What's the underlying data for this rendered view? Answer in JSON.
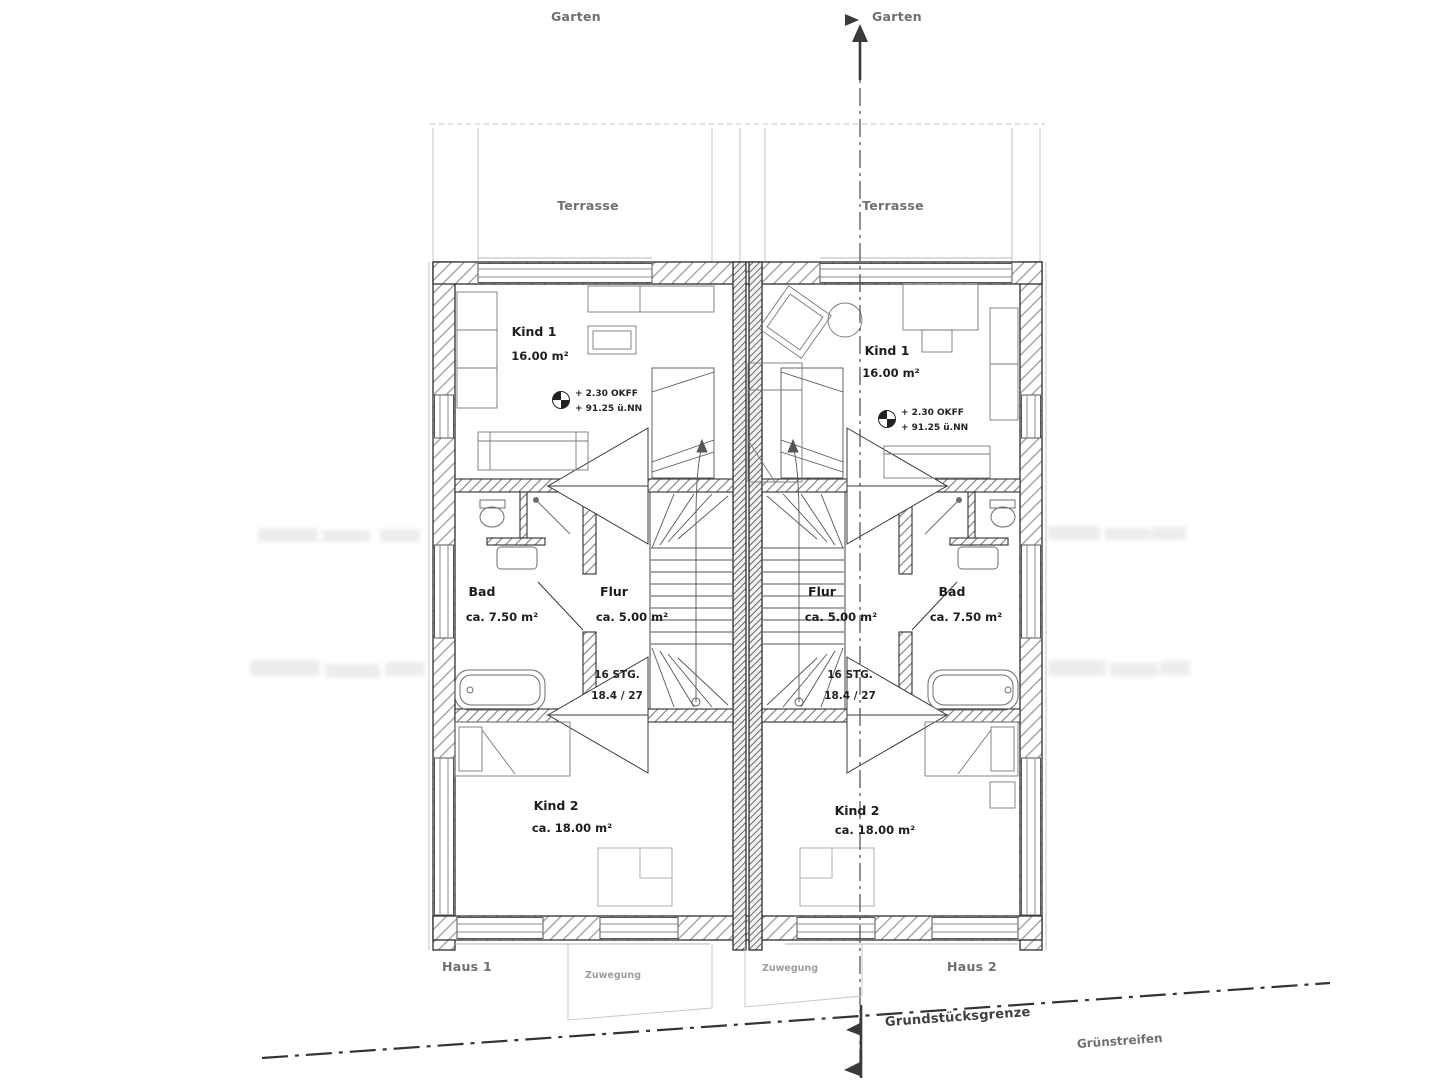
{
  "colors": {
    "ink": "#3a3a3a",
    "faint": "#c4c4c4",
    "label": "#1d1d1d"
  },
  "site": {
    "garten_left": "Garten",
    "garten_right": "Garten",
    "terrasse_left": "Terrasse",
    "terrasse_right": "Terrasse",
    "grundstuecksgrenze": "Grundstücksgrenze",
    "gruenstreifen": "Grünstreifen",
    "zuwegung_left": "Zuwegung",
    "zuwegung_right": "Zuwegung"
  },
  "haus1": {
    "name": "Haus 1",
    "kind1": {
      "name": "Kind 1",
      "area": "16.00 m²"
    },
    "kind2": {
      "name": "Kind 2",
      "area": "ca. 18.00 m²"
    },
    "bad": {
      "name": "Bad",
      "area": "ca. 7.50 m²"
    },
    "flur": {
      "name": "Flur",
      "area": "ca. 5.00 m²"
    },
    "stairs": {
      "line1": "16 STG.",
      "line2": "18.4 / 27"
    },
    "level": {
      "line1": "+ 2.30 OKFF",
      "line2": "+ 91.25 ü.NN"
    }
  },
  "haus2": {
    "name": "Haus 2",
    "kind1": {
      "name": "Kind 1",
      "area": "16.00 m²"
    },
    "kind2": {
      "name": "Kind 2",
      "area": "ca. 18.00 m²"
    },
    "bad": {
      "name": "Bad",
      "area": "ca. 7.50 m²"
    },
    "flur": {
      "name": "Flur",
      "area": "ca. 5.00 m²"
    },
    "stairs": {
      "line1": "16 STG.",
      "line2": "18.4 / 27"
    },
    "level": {
      "line1": "+ 2.30 OKFF",
      "line2": "+ 91.25 ü.NN"
    }
  }
}
